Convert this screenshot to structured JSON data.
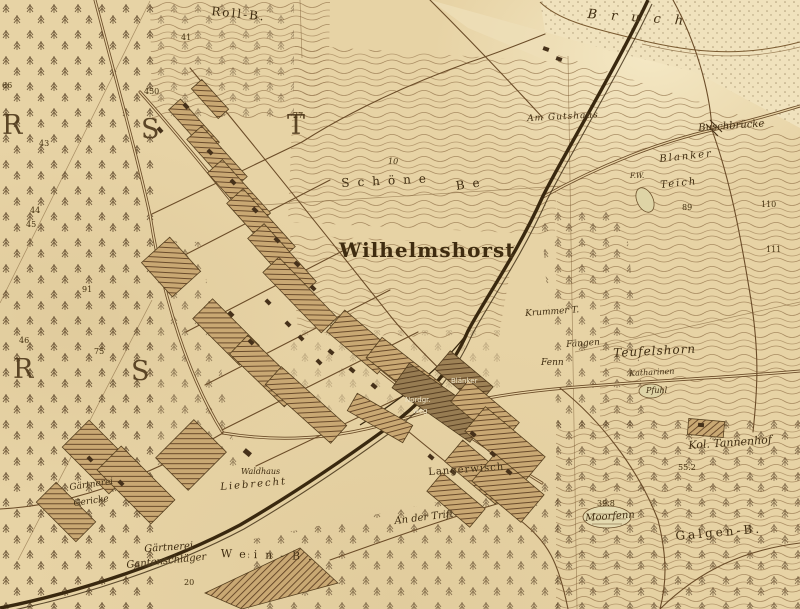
{
  "map": {
    "colors": {
      "paper": "#e7d3a5",
      "ink": "#3f2c10",
      "settlement_hatch": "#5f4123",
      "railway": "#39280f",
      "white_street_label": "#efe5c8",
      "region_letter": "#503a1c"
    },
    "region_letters": [
      {
        "t": "R",
        "x": 2,
        "y": 112
      },
      {
        "t": "S",
        "x": 141,
        "y": 116
      },
      {
        "t": "T",
        "x": 287,
        "y": 112
      },
      {
        "t": "R",
        "x": 13,
        "y": 356
      },
      {
        "t": "S",
        "x": 131,
        "y": 358
      }
    ],
    "place_labels": [
      {
        "t": "Roll-B.",
        "x": 212,
        "y": 5,
        "s": 12,
        "sp": 2,
        "r": 6
      },
      {
        "t": "Bruch",
        "x": 588,
        "y": 8,
        "s": 13,
        "it": 1,
        "sp": 14,
        "r": 4
      },
      {
        "t": "Am Gutshaus",
        "x": 527,
        "y": 115,
        "s": 9,
        "it": 1,
        "sp": 1,
        "r": -3
      },
      {
        "t": "Buschbrücke",
        "x": 698,
        "y": 124,
        "s": 10,
        "it": 1,
        "r": -4
      },
      {
        "t": "Blanker",
        "x": 659,
        "y": 155,
        "s": 10,
        "it": 1,
        "sp": 2,
        "r": -6
      },
      {
        "t": "Teich",
        "x": 660,
        "y": 181,
        "s": 10,
        "it": 1,
        "sp": 2,
        "r": -6
      },
      {
        "t": "F.W.",
        "x": 630,
        "y": 173,
        "s": 7,
        "it": 1
      },
      {
        "t": "Schöne",
        "x": 341,
        "y": 177,
        "s": 12,
        "sp": 8,
        "r": -3
      },
      {
        "t": "Be",
        "x": 455,
        "y": 180,
        "s": 12,
        "sp": 8,
        "r": -8
      },
      {
        "t": "Wilhelmshorst",
        "x": 339,
        "y": 240,
        "s": 20,
        "sp": 1,
        "w": 700
      },
      {
        "t": "Krummer T.",
        "x": 525,
        "y": 310,
        "s": 9,
        "it": 1,
        "r": -4
      },
      {
        "t": "Fängen",
        "x": 566,
        "y": 341,
        "s": 9,
        "it": 1,
        "r": -4
      },
      {
        "t": "Fenn",
        "x": 541,
        "y": 359,
        "s": 9,
        "it": 1
      },
      {
        "t": "Teufelshorn",
        "x": 613,
        "y": 347,
        "s": 12,
        "it": 1,
        "sp": 1,
        "r": -3
      },
      {
        "t": "Katharinen",
        "x": 629,
        "y": 370,
        "s": 8,
        "it": 1,
        "r": -3
      },
      {
        "t": "Pfuhl",
        "x": 646,
        "y": 387,
        "s": 8,
        "it": 1
      },
      {
        "t": "Kol. Tannenhof",
        "x": 688,
        "y": 440,
        "s": 11,
        "it": 1,
        "r": -4
      },
      {
        "t": "Moorfenn",
        "x": 585,
        "y": 514,
        "s": 10,
        "it": 1,
        "r": -4
      },
      {
        "t": "Galgen-B.",
        "x": 675,
        "y": 530,
        "s": 12,
        "sp": 3,
        "r": -5
      },
      {
        "t": "Gärtnerei",
        "x": 69,
        "y": 484,
        "s": 9,
        "it": 1,
        "r": -8
      },
      {
        "t": "Gericke",
        "x": 73,
        "y": 500,
        "s": 9,
        "it": 1,
        "r": -8
      },
      {
        "t": "Waldhaus",
        "x": 241,
        "y": 468,
        "s": 8,
        "it": 1
      },
      {
        "t": "Liebrecht",
        "x": 220,
        "y": 483,
        "s": 10,
        "it": 1,
        "sp": 2,
        "r": -5
      },
      {
        "t": "Gärtnerei",
        "x": 144,
        "y": 545,
        "s": 10,
        "it": 1,
        "r": -4
      },
      {
        "t": "Gantenschläger",
        "x": 126,
        "y": 561,
        "s": 10,
        "it": 1,
        "r": -6
      },
      {
        "t": "Wein-B.",
        "x": 221,
        "y": 548,
        "s": 11,
        "sp": 8,
        "r": 2
      },
      {
        "t": "An der Trift",
        "x": 394,
        "y": 517,
        "s": 10,
        "it": 1,
        "r": -7
      },
      {
        "t": "Langerwisch",
        "x": 428,
        "y": 468,
        "s": 10,
        "sp": 1,
        "r": -4
      },
      {
        "t": "Nordgr.",
        "x": 405,
        "y": 397,
        "s": 7,
        "c": "white"
      },
      {
        "t": "weg",
        "x": 413,
        "y": 408,
        "s": 7,
        "c": "white"
      },
      {
        "t": "Blänker",
        "x": 451,
        "y": 378,
        "s": 7,
        "c": "white"
      }
    ],
    "elevation_labels": [
      {
        "t": "66",
        "x": 2,
        "y": 82
      },
      {
        "t": "43",
        "x": 39,
        "y": 140
      },
      {
        "t": "44",
        "x": 30,
        "y": 207
      },
      {
        "t": "45",
        "x": 26,
        "y": 221
      },
      {
        "t": "91",
        "x": 82,
        "y": 286
      },
      {
        "t": "46",
        "x": 19,
        "y": 337
      },
      {
        "t": "75",
        "x": 94,
        "y": 348
      },
      {
        "t": "41",
        "x": 181,
        "y": 34
      },
      {
        "t": "450",
        "x": 144,
        "y": 88
      },
      {
        "t": "27",
        "x": 293,
        "y": 112
      },
      {
        "t": "10",
        "x": 388,
        "y": 158,
        "it": 1
      },
      {
        "t": "89",
        "x": 682,
        "y": 204
      },
      {
        "t": "110",
        "x": 761,
        "y": 201
      },
      {
        "t": "111",
        "x": 766,
        "y": 246
      },
      {
        "t": "55.2",
        "x": 678,
        "y": 464
      },
      {
        "t": "39.8",
        "x": 597,
        "y": 500
      },
      {
        "t": "20",
        "x": 184,
        "y": 579
      }
    ]
  }
}
